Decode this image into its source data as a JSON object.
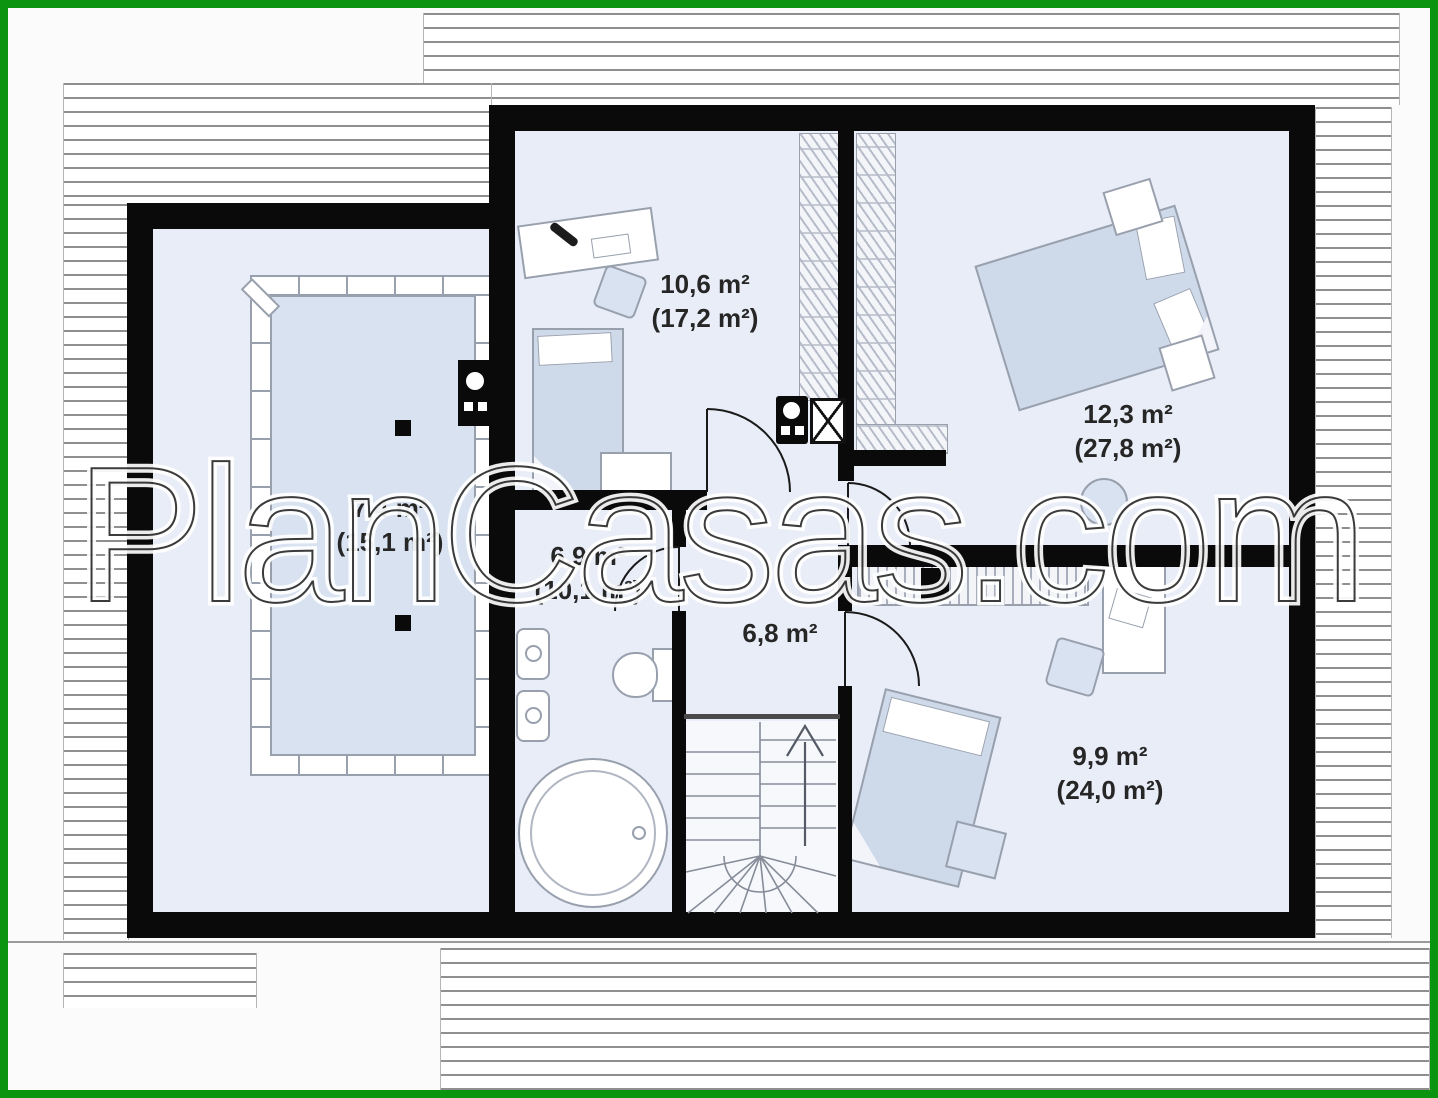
{
  "watermark": {
    "text": "PlanCasas.com"
  },
  "colors": {
    "border_green": "#0b9410",
    "wall_black": "#0a0a0a",
    "floor_blue": "#e9edf7",
    "furniture_blue": "#ced9ea",
    "void_blue": "#d9e2f1"
  },
  "plan": {
    "type": "attic-floor-plan",
    "rooms": [
      {
        "id": "study",
        "area": "10,6 m²",
        "total_area": "(17,2 m²)"
      },
      {
        "id": "bedroom-1",
        "area": "12,3 m²",
        "total_area": "(27,8 m²)"
      },
      {
        "id": "void-room",
        "area": "7,4 m²",
        "total_area": "(15,1 m²)"
      },
      {
        "id": "bathroom",
        "area": "6,9 m²",
        "total_area": "(10,1 m²)"
      },
      {
        "id": "hall",
        "area": "6,8 m²",
        "total_area": ""
      },
      {
        "id": "bedroom-2",
        "area": "9,9 m²",
        "total_area": "(24,0 m²)"
      }
    ]
  }
}
